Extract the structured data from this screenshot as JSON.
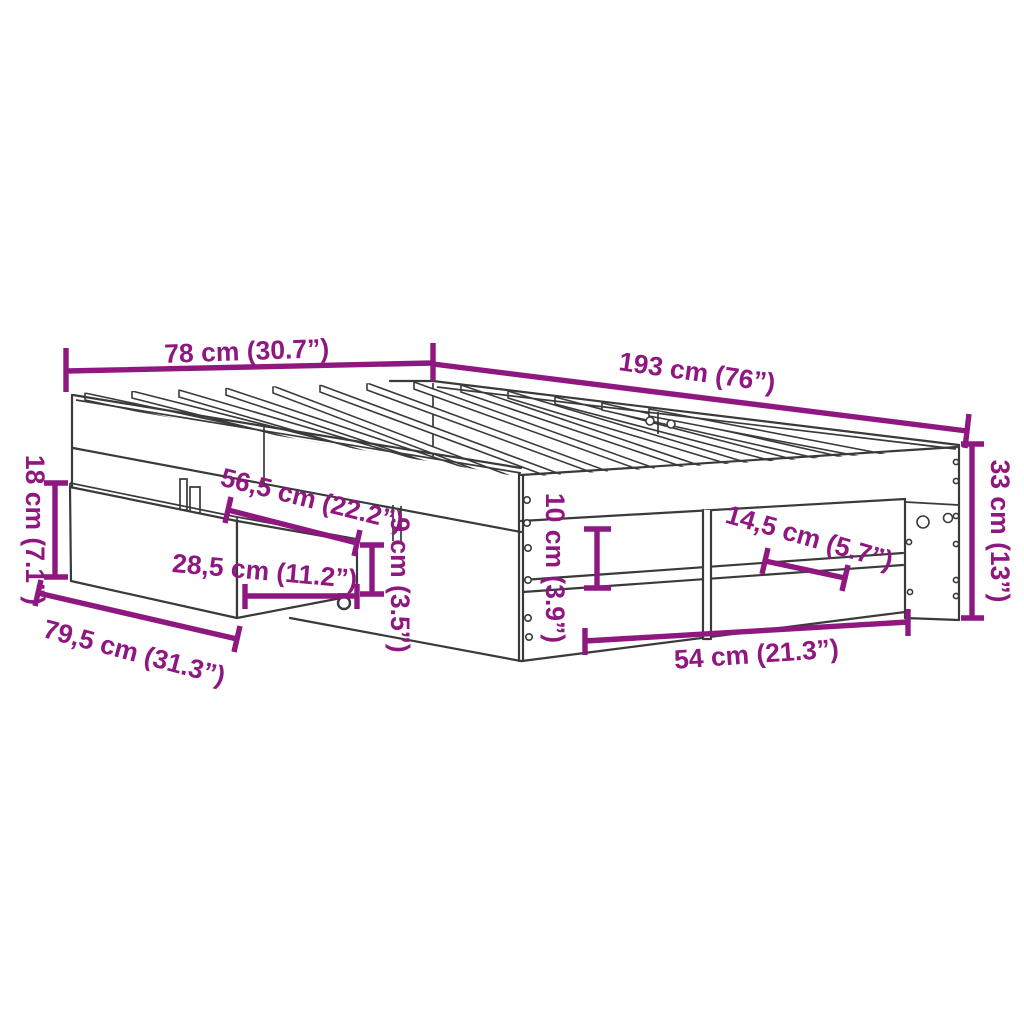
{
  "diagram": {
    "title": "Bed frame with under-bed drawer and open shelf - dimension drawing",
    "colors": {
      "dimension_color": "#8E1780",
      "line_color": "#3A3A3A",
      "background": "#FFFFFF"
    },
    "dimensions": {
      "head_width": "78 cm (30.7”)",
      "frame_length": "193 cm (76”)",
      "drawer_front_height": "18 cm (7.1”)",
      "drawer_front_width": "79,5 cm (31.3”)",
      "drawer_side_length": "56,5 cm (22.2”)",
      "drawer_side_width": "28,5 cm (11.2”)",
      "drawer_side_height": "9 cm (3.5”)",
      "rail_height": "10 cm (3.9”)",
      "shelf_clearance": "14,5 cm (5.7”)",
      "opening_width": "54 cm (21.3”)",
      "frame_height": "33 cm (13”)"
    }
  }
}
